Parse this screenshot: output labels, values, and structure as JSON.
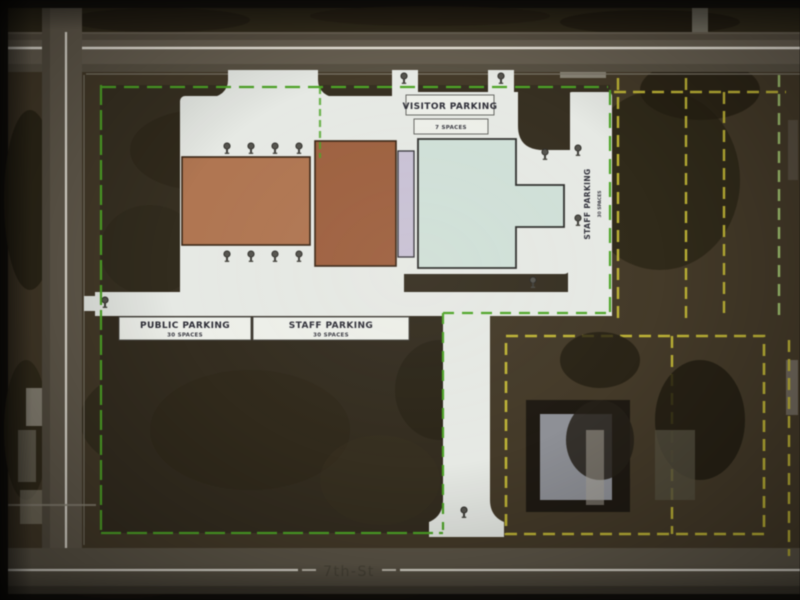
{
  "plan": {
    "labels": {
      "visitor_parking": "VISITOR PARKING",
      "visitor_spaces": "7 SPACES",
      "public_parking": "PUBLIC PARKING",
      "public_spaces": "30 SPACES",
      "staff_parking": "STAFF PARKING",
      "staff_spaces": "30 SPACES",
      "staff_parking_side": "STAFF PARKING",
      "staff_side_spaces": "30 SPACES"
    },
    "streets": {
      "bottom": "7th-St"
    },
    "colors": {
      "building_west": "#b4754e",
      "building_east_block": "#a2603c",
      "building_connector": "#c9c2d6",
      "building_east_wing": "#cfe0d8",
      "pavement": "#e6e9e4",
      "label_box": "#edefe9",
      "property_line": "#49a81f",
      "lot_line": "#c0b42c",
      "lot_line_light": "#9fc46a",
      "street_line": "#e8e4d8",
      "aerial_ground": "#453a27"
    },
    "icons": {
      "tree_icon": "plan tree symbol (circle head with stem)"
    }
  }
}
